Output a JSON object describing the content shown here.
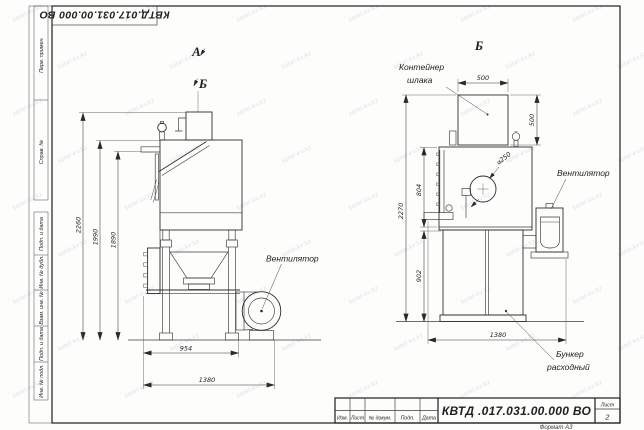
{
  "watermark": {
    "text": "kotel-kv.kz"
  },
  "stamp_top": {
    "doc_number": "КВТД.017.031.00.000 ВО"
  },
  "margin_labels": {
    "perv": "Перв. примен.",
    "sprav": "Справ. №",
    "podp1": "Подп. и дата",
    "inv_dubl": "Инв. № дубл.",
    "vzam": "Взам. инв. №",
    "podp2": "Подп. и дата",
    "inv_podl": "Инв. № подл."
  },
  "views": {
    "left": {
      "label_a": "А",
      "label_b": "Б",
      "fan_label": "Вентилятор",
      "dims": {
        "total_height": "2260",
        "mid_height": "1990",
        "body_height": "1890",
        "width_inner": "954",
        "width_total": "1380"
      }
    },
    "right": {
      "label_b": "Б",
      "container_line1": "Контейнер",
      "container_line2": "шлака",
      "fan_label": "Вентилятор",
      "bunker_line1": "Бункер",
      "bunker_line2": "расходный",
      "dims": {
        "container_width": "500",
        "container_height": "500",
        "flue_diameter": "⌀250",
        "body_height": "804",
        "total_height": "2270",
        "bunker_height": "902",
        "width_total": "1380"
      }
    }
  },
  "title_block": {
    "headers": [
      "Изм.",
      "Лист",
      "№ докум.",
      "Подп.",
      "Дата"
    ],
    "doc_number": "КВТД .017.031.00.000  ВО",
    "sheet_label": "Лист",
    "sheet_number": "2",
    "format_label": "Формат А3"
  }
}
